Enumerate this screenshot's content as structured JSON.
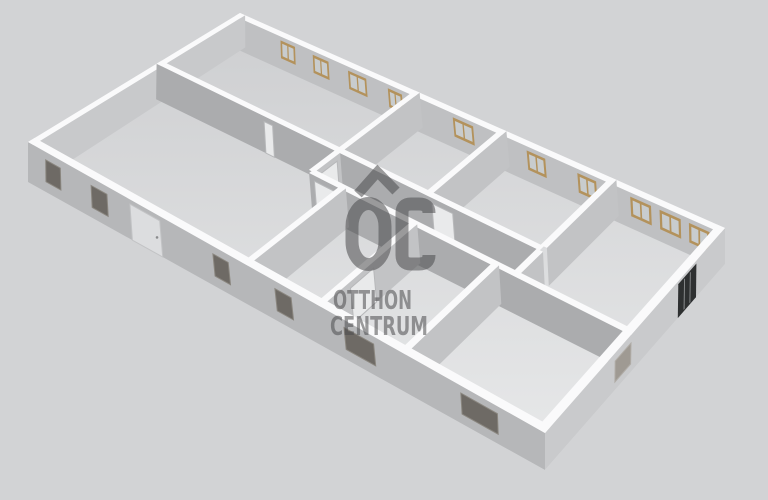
{
  "watermark": {
    "monogram": "OC",
    "line1": "OTTHON",
    "line2": "CENTRUM",
    "color": "#4c4c4e",
    "opacity": 0.55
  },
  "scene": {
    "background": "#d2d3d5",
    "wall_top": "#fafafb",
    "floor_far": "#cfd0d2",
    "floor_near": "#e8e9ea",
    "window_frame_tan": "#b3925c",
    "window_glass": "#c8ccce",
    "window_dark_fill": "#6e6a65",
    "window_dark_stroke": "#8a867f",
    "window_gray_fill": "#9f9a93",
    "window_gray_stroke": "#b0aca6",
    "door_light_fill": "#dcdddf",
    "door_light_stroke": "#c2c3c5",
    "door_dark_fill": "#2e3031",
    "door_dark_slat": "#97999b",
    "door_white_fill": "#e9eaeb",
    "door_white_stroke": "#b7b8ba",
    "handle": "#8a8b8d"
  },
  "floorplan": {
    "plan_width": 100,
    "plan_depth": 47,
    "corners_top": [
      [
        240,
        13
      ],
      [
        725,
        228
      ],
      [
        545,
        433
      ],
      [
        28,
        142
      ]
    ],
    "corners_floor": [
      [
        240,
        45
      ],
      [
        725,
        264
      ],
      [
        545,
        470
      ],
      [
        28,
        182
      ]
    ],
    "walls": [
      {
        "id": "exterior-back-right",
        "axis": "u",
        "from": 0,
        "to": 100,
        "band": [
          0,
          1.3
        ],
        "color": "#bfc0c2",
        "openings": [
          {
            "type": "win_tan",
            "a": 11.3,
            "b": 14.8,
            "h0": 0.34,
            "h1": 0.88
          },
          {
            "type": "win_tan",
            "a": 19.0,
            "b": 22.7,
            "h0": 0.34,
            "h1": 0.88
          },
          {
            "type": "win_tan",
            "a": 27.2,
            "b": 31.3,
            "h0": 0.34,
            "h1": 0.88
          },
          {
            "type": "win_tan",
            "a": 36.1,
            "b": 39.2,
            "h0": 0.34,
            "h1": 0.88
          },
          {
            "type": "win_tan",
            "a": 50.0,
            "b": 54.2,
            "h0": 0.34,
            "h1": 0.88
          },
          {
            "type": "win_tan",
            "a": 64.9,
            "b": 68.5,
            "h0": 0.34,
            "h1": 0.88
          },
          {
            "type": "win_tan",
            "a": 74.6,
            "b": 78.1,
            "h0": 0.34,
            "h1": 0.88
          },
          {
            "type": "win_tan",
            "a": 84.3,
            "b": 88.0,
            "h0": 0.34,
            "h1": 0.88
          },
          {
            "type": "win_tan",
            "a": 89.5,
            "b": 93.2,
            "h0": 0.34,
            "h1": 0.88
          },
          {
            "type": "win_tan",
            "a": 94.6,
            "b": 98.1,
            "h0": 0.34,
            "h1": 0.88
          }
        ]
      },
      {
        "id": "exterior-back-left",
        "axis": "v",
        "from": 0,
        "to": 47,
        "band": [
          0,
          1.3
        ],
        "color": "#c8c9cb",
        "openings": []
      },
      {
        "id": "divider-room3-left",
        "axis": "v",
        "from": 0,
        "to": 19.5,
        "band": [
          58.95,
          60.05
        ],
        "color": "#c2c3c5",
        "openings": []
      },
      {
        "id": "divider-room2-left-upper",
        "axis": "v",
        "from": 0,
        "to": 19.0,
        "band": [
          40.95,
          42.05
        ],
        "color": "#c2c3c5",
        "openings": []
      },
      {
        "id": "divider-room4-left-upper",
        "axis": "v",
        "from": 0,
        "to": 19.0,
        "band": [
          79.95,
          81.05
        ],
        "color": "#c2c3c5",
        "openings": []
      },
      {
        "id": "hallway-upper",
        "axis": "u",
        "from": 0,
        "to": 80.5,
        "band": [
          18.95,
          20.05
        ],
        "color": "#abacae",
        "openings": [
          {
            "type": "door_white",
            "a": 25.5,
            "b": 27.4,
            "h0": 0,
            "h1": 0.85
          },
          {
            "type": "door_white",
            "a": 60.5,
            "b": 64.5,
            "h0": 0,
            "h1": 0.85
          }
        ]
      },
      {
        "id": "divider-room2-left-lower",
        "axis": "v",
        "from": 20.0,
        "to": 26.0,
        "band": [
          40.95,
          42.05
        ],
        "color": "#c2c3c5",
        "openings": [
          {
            "type": "door_white",
            "a": 20.8,
            "b": 24.8,
            "h0": 0,
            "h1": 0.85
          }
        ]
      },
      {
        "id": "divider-room4-left-lower",
        "axis": "v",
        "from": 20.0,
        "to": 26.0,
        "band": [
          79.95,
          81.05
        ],
        "color": "#c2c3c5",
        "openings": []
      },
      {
        "id": "hallway-lower",
        "axis": "u",
        "from": 41.5,
        "to": 100,
        "band": [
          25.45,
          26.55
        ],
        "color": "#abacae",
        "openings": [
          {
            "type": "door_white",
            "a": 42.5,
            "b": 46.5,
            "h0": 0,
            "h1": 0.85
          }
        ]
      },
      {
        "id": "divider-front-room2",
        "axis": "v",
        "from": 26,
        "to": 47,
        "band": [
          47.45,
          48.55
        ],
        "color": "#c2c3c5",
        "openings": []
      },
      {
        "id": "divider-front-room3",
        "axis": "v",
        "from": 26,
        "to": 47,
        "band": [
          61.45,
          62.55
        ],
        "color": "#c2c3c5",
        "openings": [
          {
            "type": "door_white",
            "a": 36.0,
            "b": 41.0,
            "h0": 0,
            "h1": 0.85
          }
        ]
      },
      {
        "id": "divider-front-room4",
        "axis": "v",
        "from": 26,
        "to": 47,
        "band": [
          76.45,
          77.55
        ],
        "color": "#c2c3c5",
        "openings": []
      },
      {
        "id": "exterior-front-right",
        "axis": "v",
        "from": 0,
        "to": 47,
        "band": [
          98.7,
          100
        ],
        "color": "#c9cacc",
        "openings": [
          {
            "type": "door_dark",
            "a": 8.6,
            "b": 13.8,
            "h0": 0,
            "h1": 0.92
          },
          {
            "type": "win_gray",
            "a": 26.5,
            "b": 30.5,
            "h0": 0.22,
            "h1": 0.78
          }
        ]
      },
      {
        "id": "exterior-front-left",
        "axis": "u",
        "from": 0,
        "to": 100,
        "band": [
          45.7,
          47
        ],
        "color": "#b6b7b9",
        "openings": [
          {
            "type": "win_dark",
            "a": 4.3,
            "b": 7.8,
            "h0": 0.26,
            "h1": 0.8
          },
          {
            "type": "win_dark",
            "a": 15.0,
            "b": 18.6,
            "h0": 0.26,
            "h1": 0.8
          },
          {
            "type": "door_light",
            "a": 23.8,
            "b": 30.3,
            "h0": 0,
            "h1": 0.88
          },
          {
            "type": "win_dark",
            "a": 41.4,
            "b": 44.5,
            "h0": 0.26,
            "h1": 0.8
          },
          {
            "type": "win_dark",
            "a": 53.7,
            "b": 56.8,
            "h0": 0.26,
            "h1": 0.8
          },
          {
            "type": "win_dark",
            "a": 66.6,
            "b": 71.9,
            "h0": 0.26,
            "h1": 0.8
          },
          {
            "type": "win_dark",
            "a": 86.7,
            "b": 92.6,
            "h0": 0.26,
            "h1": 0.8
          }
        ]
      }
    ]
  }
}
